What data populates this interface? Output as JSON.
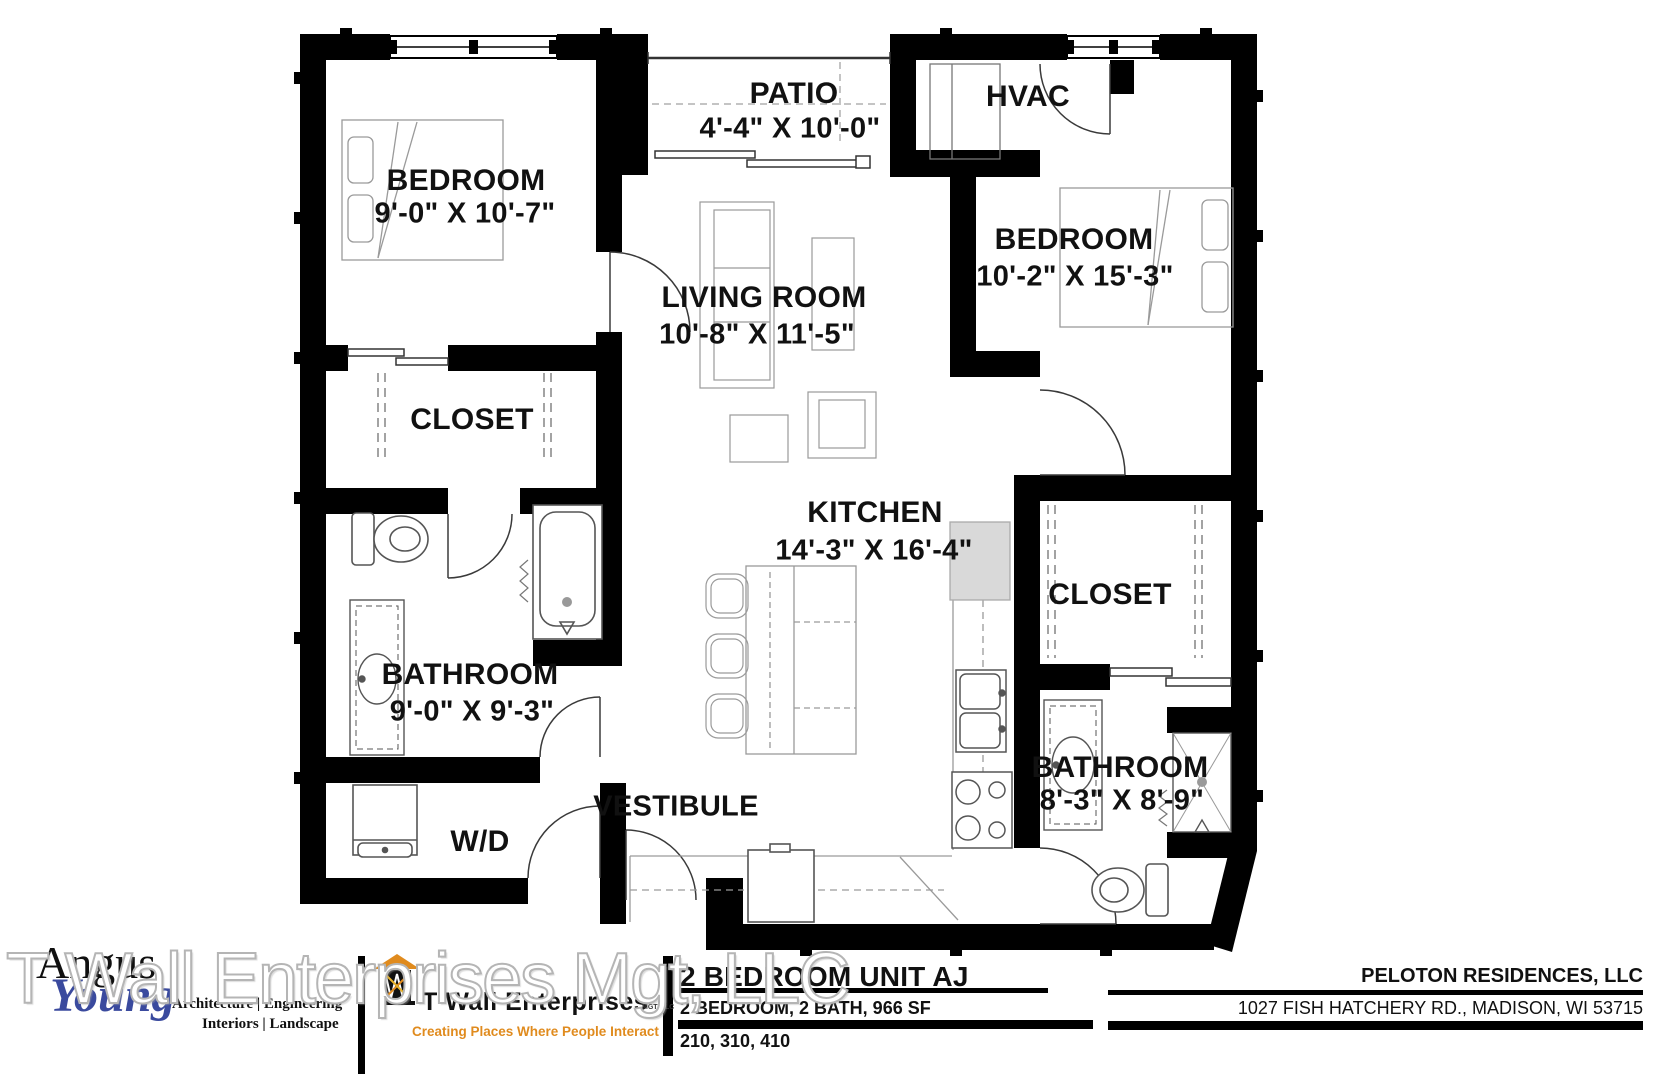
{
  "rooms": {
    "bedroom1": {
      "name": "BEDROOM",
      "dims": "9'-0\" X 10'-7\""
    },
    "patio": {
      "name": "PATIO",
      "dims": "4'-4\" X 10'-0\""
    },
    "hvac": {
      "name": "HVAC"
    },
    "bedroom2": {
      "name": "BEDROOM",
      "dims": "10'-2\" X 15'-3\""
    },
    "living_room": {
      "name": "LIVING ROOM",
      "dims": "10'-8\" X 11'-5\""
    },
    "closet1": {
      "name": "CLOSET"
    },
    "kitchen": {
      "name": "KITCHEN",
      "dims": "14'-3\" X 16'-4\""
    },
    "closet2": {
      "name": "CLOSET"
    },
    "bathroom1": {
      "name": "BATHROOM",
      "dims": "9'-0\" X 9'-3\""
    },
    "bathroom2": {
      "name": "BATHROOM",
      "dims": "8'-3\" X 8'-9\""
    },
    "wd": {
      "name": "W/D"
    },
    "vestibule": {
      "name": "VESTIBULE"
    }
  },
  "title_block": {
    "architect": {
      "name_line1": "Angus",
      "name_line2": "Young",
      "services_line1": "Architecture | Engineering",
      "services_line2": "Interiors | Landscape"
    },
    "developer": {
      "name": "T Wall Enterprises",
      "suffix": "MGT, LLC",
      "tagline": "Creating Places Where People Interact"
    },
    "unit": {
      "title": "2 BEDROOM UNIT AJ",
      "specs": "2 BEDROOM, 2 BATH, 966  SF",
      "unit_numbers": "210, 310, 410"
    },
    "owner": {
      "name": "PELOTON RESIDENCES, LLC",
      "address": "1027 FISH HATCHERY RD., MADISON, WI 53715"
    }
  },
  "watermark": "T Wall Enterprises Mgt, LLC",
  "colors": {
    "walls": "#000000",
    "accent_orange": "#e08b1e",
    "architect_blue": "#3a4a9e",
    "furniture_line": "#9a9a9a",
    "fixture_line": "#555555"
  }
}
